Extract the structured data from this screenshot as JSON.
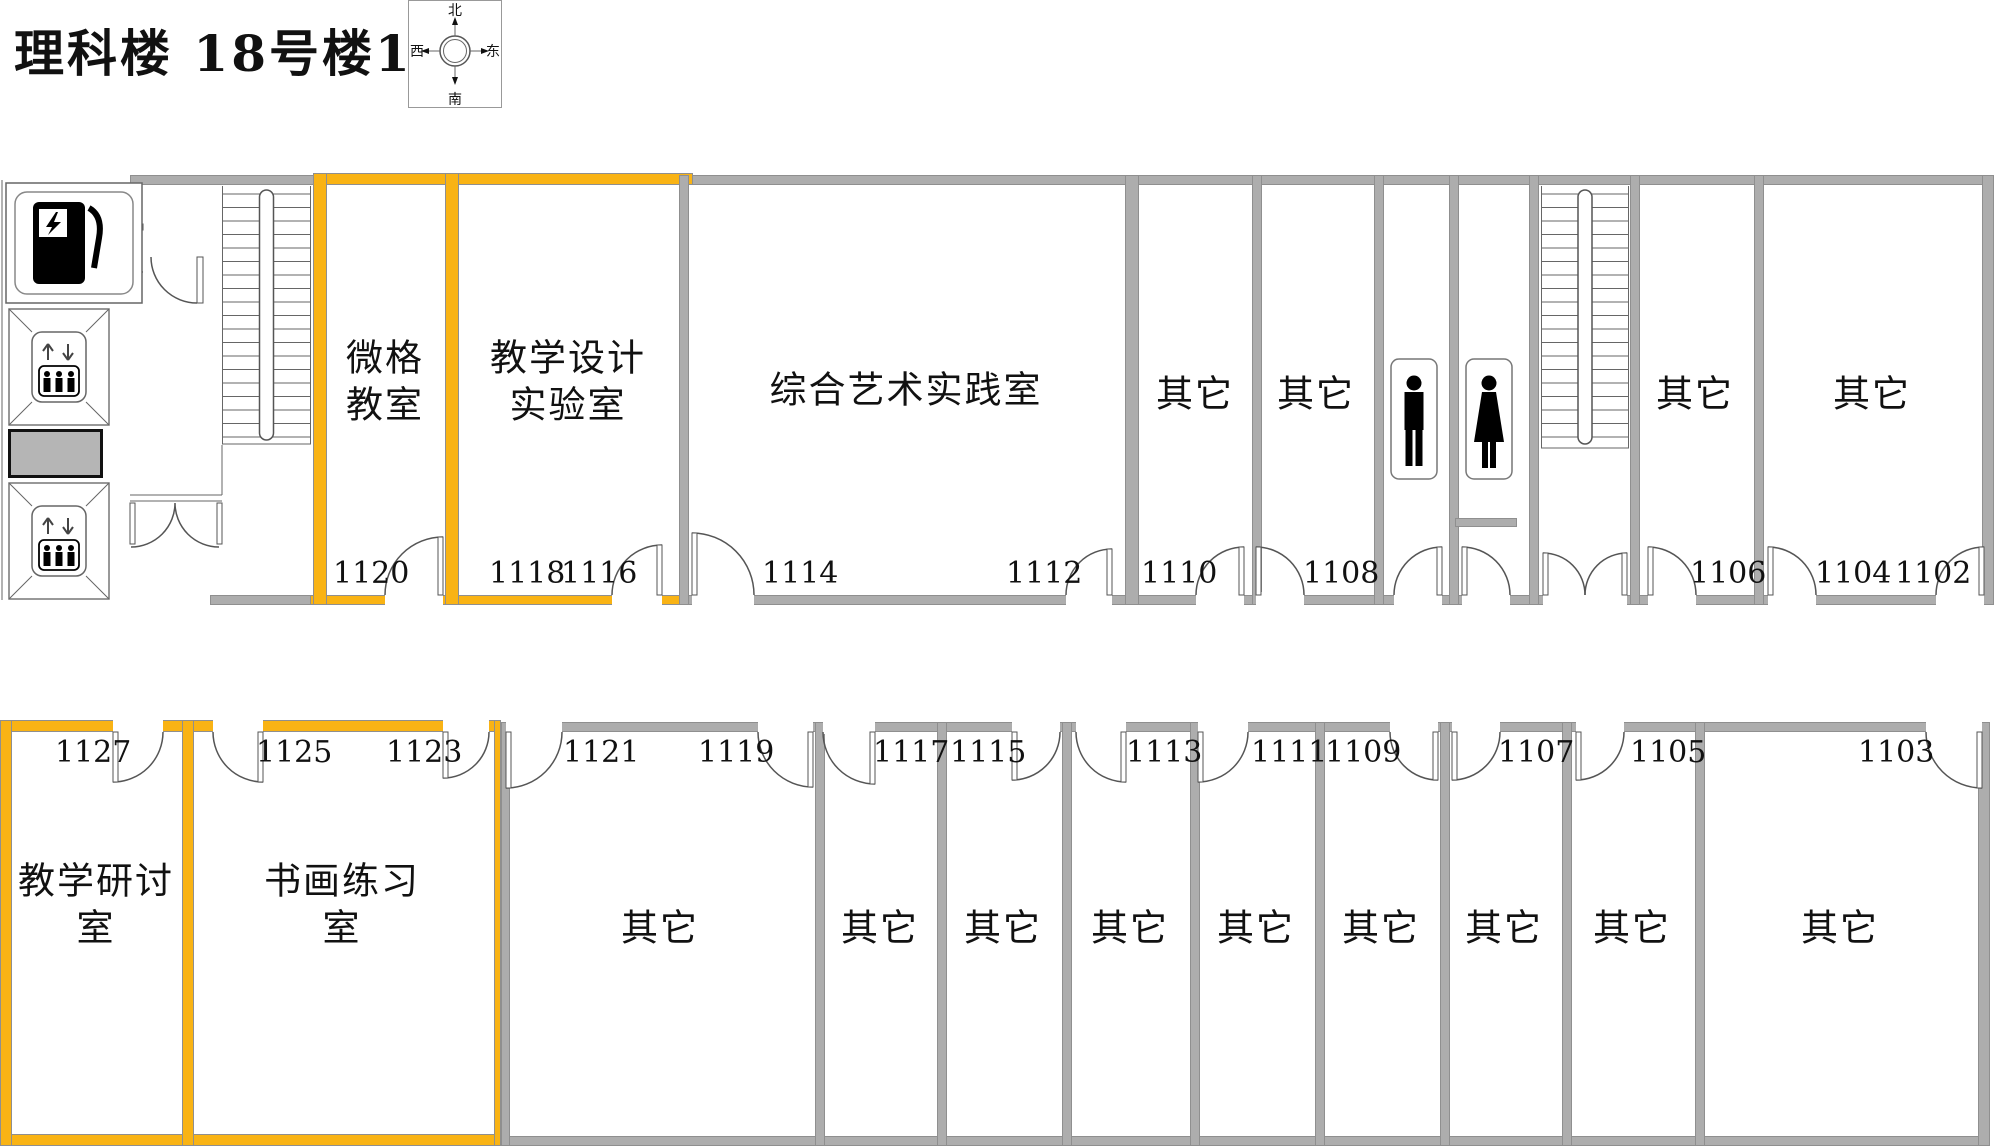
{
  "title": "理科楼 18号楼11层",
  "compass": {
    "north": "北",
    "south": "南",
    "east": "东",
    "west": "西"
  },
  "colors": {
    "highlight": "#F9B314",
    "wall": "#ADADAD",
    "wall_edge": "#8F8F8F",
    "shaft_fill": "#B5B5B5",
    "line": "#111111"
  },
  "rooms": [
    {
      "id": "1120",
      "label": {
        "lines": [
          "微格",
          "教室"
        ],
        "x": 385,
        "y": 382
      },
      "numbers": [
        {
          "t": "1120",
          "x": 333,
          "y": 556
        }
      ],
      "highlighted": true,
      "area": {
        "x": 327,
        "y": 185,
        "w": 118,
        "h": 410
      }
    },
    {
      "id": "1118-1116",
      "label": {
        "lines": [
          "教学设计",
          "实验室"
        ],
        "x": 568,
        "y": 382
      },
      "numbers": [
        {
          "t": "1118",
          "x": 489,
          "y": 556
        },
        {
          "t": "1116",
          "x": 561,
          "y": 556
        }
      ],
      "highlighted": true,
      "area": {
        "x": 459,
        "y": 185,
        "w": 220,
        "h": 410
      }
    },
    {
      "id": "1114-1112",
      "label": {
        "lines": [
          "综合艺术实践室"
        ],
        "x": 906,
        "y": 390
      },
      "numbers": [
        {
          "t": "1114",
          "x": 762,
          "y": 556
        },
        {
          "t": "1112",
          "x": 1006,
          "y": 556
        }
      ],
      "highlighted": false,
      "area": {
        "x": 689,
        "y": 185,
        "w": 436,
        "h": 410
      }
    },
    {
      "id": "1110",
      "label": {
        "lines": [
          "其它"
        ],
        "x": 1195,
        "y": 394
      },
      "numbers": [
        {
          "t": "1110",
          "x": 1141,
          "y": 556
        }
      ],
      "highlighted": false,
      "area": {
        "x": 1139,
        "y": 185,
        "w": 113,
        "h": 410
      }
    },
    {
      "id": "1108",
      "label": {
        "lines": [
          "其它"
        ],
        "x": 1316,
        "y": 394
      },
      "numbers": [
        {
          "t": "1108",
          "x": 1303,
          "y": 556
        }
      ],
      "highlighted": false,
      "area": {
        "x": 1262,
        "y": 185,
        "w": 112,
        "h": 410
      }
    },
    {
      "id": "1106",
      "label": {
        "lines": [
          "其它"
        ],
        "x": 1695,
        "y": 394
      },
      "numbers": [
        {
          "t": "1106",
          "x": 1690,
          "y": 556
        }
      ],
      "highlighted": false,
      "area": {
        "x": 1640,
        "y": 185,
        "w": 114,
        "h": 410
      }
    },
    {
      "id": "1104-1102",
      "label": {
        "lines": [
          "其它"
        ],
        "x": 1872,
        "y": 394
      },
      "numbers": [
        {
          "t": "1104",
          "x": 1815,
          "y": 556
        },
        {
          "t": "1102",
          "x": 1895,
          "y": 556
        }
      ],
      "highlighted": false,
      "area": {
        "x": 1764,
        "y": 185,
        "w": 218,
        "h": 410
      }
    },
    {
      "id": "1127",
      "label": {
        "lines": [
          "教学研讨",
          "室"
        ],
        "x": 96,
        "y": 905
      },
      "numbers": [
        {
          "t": "1127",
          "x": 55,
          "y": 735
        }
      ],
      "highlighted": true,
      "area": {
        "x": 12,
        "y": 732,
        "w": 170,
        "h": 404
      }
    },
    {
      "id": "1125-1123",
      "label": {
        "lines": [
          "书画练习",
          "室"
        ],
        "x": 342,
        "y": 905
      },
      "numbers": [
        {
          "t": "1125",
          "x": 256,
          "y": 735
        },
        {
          "t": "1123",
          "x": 386,
          "y": 735
        }
      ],
      "highlighted": true,
      "area": {
        "x": 194,
        "y": 732,
        "w": 300,
        "h": 404
      }
    },
    {
      "id": "1121-1119",
      "label": {
        "lines": [
          "其它"
        ],
        "x": 660,
        "y": 928
      },
      "numbers": [
        {
          "t": "1121",
          "x": 563,
          "y": 735
        },
        {
          "t": "1119",
          "x": 698,
          "y": 735
        }
      ],
      "highlighted": false,
      "area": {
        "x": 510,
        "y": 732,
        "w": 305,
        "h": 404
      }
    },
    {
      "id": "1117",
      "label": {
        "lines": [
          "其它"
        ],
        "x": 880,
        "y": 928
      },
      "numbers": [
        {
          "t": "1117",
          "x": 873,
          "y": 735
        }
      ],
      "highlighted": false,
      "area": {
        "x": 825,
        "y": 732,
        "w": 112,
        "h": 404
      }
    },
    {
      "id": "1115",
      "label": {
        "lines": [
          "其它"
        ],
        "x": 1003,
        "y": 928
      },
      "numbers": [
        {
          "t": "1115",
          "x": 950,
          "y": 735
        }
      ],
      "highlighted": false,
      "area": {
        "x": 947,
        "y": 732,
        "w": 115,
        "h": 404
      }
    },
    {
      "id": "1113",
      "label": {
        "lines": [
          "其它"
        ],
        "x": 1130,
        "y": 928
      },
      "numbers": [
        {
          "t": "1113",
          "x": 1126,
          "y": 735
        }
      ],
      "highlighted": false,
      "area": {
        "x": 1072,
        "y": 732,
        "w": 118,
        "h": 404
      }
    },
    {
      "id": "1111",
      "label": {
        "lines": [
          "其它"
        ],
        "x": 1256,
        "y": 928
      },
      "numbers": [
        {
          "t": "1111",
          "x": 1251,
          "y": 735
        }
      ],
      "highlighted": false,
      "area": {
        "x": 1200,
        "y": 732,
        "w": 115,
        "h": 404
      }
    },
    {
      "id": "1109",
      "label": {
        "lines": [
          "其它"
        ],
        "x": 1381,
        "y": 928
      },
      "numbers": [
        {
          "t": "1109",
          "x": 1325,
          "y": 735
        }
      ],
      "highlighted": false,
      "area": {
        "x": 1325,
        "y": 732,
        "w": 115,
        "h": 404
      }
    },
    {
      "id": "1107",
      "label": {
        "lines": [
          "其它"
        ],
        "x": 1504,
        "y": 928
      },
      "numbers": [
        {
          "t": "1107",
          "x": 1498,
          "y": 735
        }
      ],
      "highlighted": false,
      "area": {
        "x": 1450,
        "y": 732,
        "w": 112,
        "h": 404
      }
    },
    {
      "id": "1105",
      "label": {
        "lines": [
          "其它"
        ],
        "x": 1632,
        "y": 928
      },
      "numbers": [
        {
          "t": "1105",
          "x": 1630,
          "y": 735
        }
      ],
      "highlighted": false,
      "area": {
        "x": 1572,
        "y": 732,
        "w": 123,
        "h": 404
      }
    },
    {
      "id": "1103",
      "label": {
        "lines": [
          "其它"
        ],
        "x": 1840,
        "y": 928
      },
      "numbers": [
        {
          "t": "1103",
          "x": 1858,
          "y": 735
        }
      ],
      "highlighted": false,
      "area": {
        "x": 1705,
        "y": 732,
        "w": 273,
        "h": 404
      }
    }
  ],
  "walls": [
    [
      130,
      175,
      1862,
      10,
      "g"
    ],
    [
      315,
      173,
      378,
      12,
      "o"
    ],
    [
      210,
      595,
      1782,
      10,
      "g"
    ],
    [
      310,
      595,
      149,
      10,
      "o"
    ],
    [
      455,
      595,
      232,
      10,
      "o"
    ],
    [
      313,
      173,
      14,
      432,
      "o"
    ],
    [
      445,
      173,
      14,
      432,
      "o"
    ],
    [
      679,
      175,
      10,
      430,
      "g"
    ],
    [
      1125,
      175,
      14,
      430,
      "g"
    ],
    [
      1252,
      175,
      10,
      430,
      "g"
    ],
    [
      1374,
      175,
      10,
      430,
      "g"
    ],
    [
      1449,
      175,
      10,
      430,
      "g"
    ],
    [
      1529,
      175,
      10,
      430,
      "g"
    ],
    [
      1630,
      175,
      10,
      430,
      "g"
    ],
    [
      1754,
      175,
      10,
      430,
      "g"
    ],
    [
      1982,
      175,
      12,
      430,
      "g"
    ],
    [
      1455,
      518,
      62,
      9,
      "g"
    ],
    [
      0,
      722,
      1988,
      10,
      "g"
    ],
    [
      0,
      720,
      500,
      12,
      "o"
    ],
    [
      0,
      1136,
      1988,
      10,
      "g"
    ],
    [
      0,
      1134,
      502,
      12,
      "o"
    ],
    [
      0,
      720,
      12,
      426,
      "o"
    ],
    [
      182,
      720,
      12,
      426,
      "o"
    ],
    [
      494,
      720,
      7,
      426,
      "o"
    ],
    [
      501,
      722,
      9,
      424,
      "g"
    ],
    [
      815,
      722,
      10,
      424,
      "g"
    ],
    [
      937,
      722,
      10,
      424,
      "g"
    ],
    [
      1062,
      722,
      10,
      424,
      "g"
    ],
    [
      1190,
      722,
      10,
      424,
      "g"
    ],
    [
      1315,
      722,
      10,
      424,
      "g"
    ],
    [
      1440,
      722,
      10,
      424,
      "g"
    ],
    [
      1562,
      722,
      10,
      424,
      "g"
    ],
    [
      1695,
      722,
      10,
      424,
      "g"
    ],
    [
      1978,
      722,
      12,
      424,
      "g"
    ]
  ],
  "door_gaps": [
    [
      385,
      592,
      58,
      15
    ],
    [
      612,
      592,
      50,
      15
    ],
    [
      692,
      592,
      62,
      15
    ],
    [
      1066,
      592,
      46,
      15
    ],
    [
      1196,
      592,
      48,
      15
    ],
    [
      1256,
      592,
      48,
      15
    ],
    [
      1394,
      592,
      48,
      15
    ],
    [
      1462,
      592,
      48,
      15
    ],
    [
      1543,
      592,
      84,
      15
    ],
    [
      1648,
      592,
      48,
      15
    ],
    [
      1768,
      592,
      48,
      15
    ],
    [
      1936,
      592,
      48,
      15
    ],
    [
      113,
      718,
      50,
      16
    ],
    [
      213,
      718,
      50,
      16
    ],
    [
      443,
      718,
      46,
      16
    ],
    [
      506,
      718,
      56,
      16
    ],
    [
      758,
      718,
      55,
      16
    ],
    [
      823,
      718,
      52,
      16
    ],
    [
      1012,
      718,
      48,
      16
    ],
    [
      1076,
      718,
      50,
      16
    ],
    [
      1198,
      718,
      50,
      16
    ],
    [
      1390,
      718,
      48,
      16
    ],
    [
      1452,
      718,
      48,
      16
    ],
    [
      1576,
      718,
      48,
      16
    ],
    [
      1926,
      718,
      56,
      16
    ]
  ],
  "doors": [
    {
      "x": 385,
      "w": 58,
      "hinge": "r",
      "swing": "up"
    },
    {
      "x": 612,
      "w": 50,
      "hinge": "r",
      "swing": "up"
    },
    {
      "x": 692,
      "w": 62,
      "hinge": "l",
      "swing": "up"
    },
    {
      "x": 1066,
      "w": 46,
      "hinge": "r",
      "swing": "up"
    },
    {
      "x": 1196,
      "w": 48,
      "hinge": "r",
      "swing": "up"
    },
    {
      "x": 1256,
      "w": 48,
      "hinge": "l",
      "swing": "up"
    },
    {
      "x": 1394,
      "w": 48,
      "hinge": "r",
      "swing": "up"
    },
    {
      "x": 1462,
      "w": 48,
      "hinge": "l",
      "swing": "up"
    },
    {
      "x": 1543,
      "w": 42,
      "hinge": "l",
      "swing": "up"
    },
    {
      "x": 1585,
      "w": 42,
      "hinge": "r",
      "swing": "up"
    },
    {
      "x": 1648,
      "w": 48,
      "hinge": "l",
      "swing": "up"
    },
    {
      "x": 1768,
      "w": 48,
      "hinge": "l",
      "swing": "up"
    },
    {
      "x": 1936,
      "w": 48,
      "hinge": "r",
      "swing": "up"
    },
    {
      "x": 113,
      "w": 50,
      "hinge": "l",
      "swing": "down"
    },
    {
      "x": 213,
      "w": 50,
      "hinge": "r",
      "swing": "down"
    },
    {
      "x": 443,
      "w": 46,
      "hinge": "l",
      "swing": "down"
    },
    {
      "x": 506,
      "w": 56,
      "hinge": "l",
      "swing": "down"
    },
    {
      "x": 758,
      "w": 55,
      "hinge": "r",
      "swing": "down"
    },
    {
      "x": 823,
      "w": 52,
      "hinge": "r",
      "swing": "down"
    },
    {
      "x": 1012,
      "w": 48,
      "hinge": "l",
      "swing": "down"
    },
    {
      "x": 1076,
      "w": 50,
      "hinge": "r",
      "swing": "down"
    },
    {
      "x": 1198,
      "w": 50,
      "hinge": "l",
      "swing": "down"
    },
    {
      "x": 1390,
      "w": 48,
      "hinge": "r",
      "swing": "down"
    },
    {
      "x": 1452,
      "w": 48,
      "hinge": "l",
      "swing": "down"
    },
    {
      "x": 1576,
      "w": 48,
      "hinge": "l",
      "swing": "down"
    },
    {
      "x": 1926,
      "w": 56,
      "hinge": "r",
      "swing": "down"
    }
  ],
  "facilities": [
    {
      "type": "power",
      "x": 5,
      "y": 182,
      "w": 138,
      "h": 122
    },
    {
      "type": "elevator",
      "x": 8,
      "y": 308,
      "w": 102,
      "h": 118
    },
    {
      "type": "shaft",
      "x": 8,
      "y": 429,
      "w": 95,
      "h": 49
    },
    {
      "type": "elevator",
      "x": 8,
      "y": 482,
      "w": 102,
      "h": 118
    },
    {
      "type": "stairs",
      "x": 222,
      "y": 186,
      "w": 89,
      "h": 258
    },
    {
      "type": "stairs",
      "x": 1541,
      "y": 186,
      "w": 88,
      "h": 262
    },
    {
      "type": "wc-male",
      "x": 1390,
      "y": 358,
      "w": 48,
      "h": 122
    },
    {
      "type": "wc-female",
      "x": 1465,
      "y": 358,
      "w": 48,
      "h": 122
    }
  ]
}
